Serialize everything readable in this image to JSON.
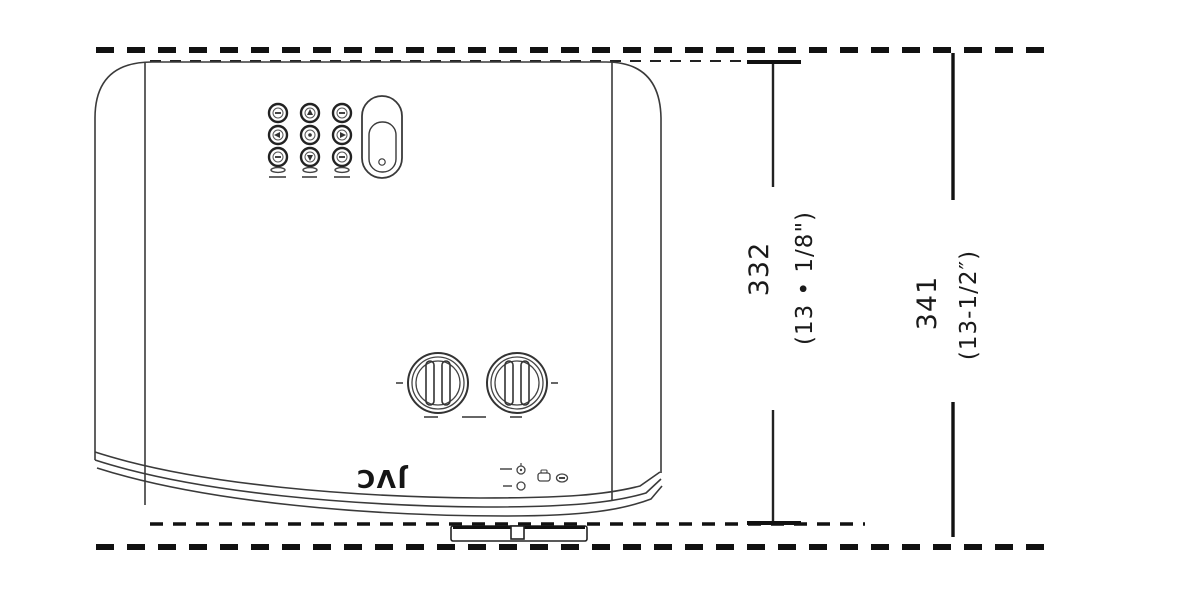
{
  "diagram": {
    "logo_text": "JVC",
    "dim_inner_mm": "332",
    "dim_inner_in": "(13 • 1/8\")",
    "dim_outer_mm": "341",
    "dim_outer_in": "(13-1/2″)"
  },
  "colors": {
    "line": "#333333",
    "dash": "#111111",
    "text": "#1a1a1a",
    "background": "#ffffff"
  },
  "icons": [
    "arrow-up-button",
    "arrow-down-button",
    "arrow-left-button",
    "arrow-right-button",
    "ok-button",
    "function-button",
    "power-slider",
    "focus-dial",
    "zoom-dial",
    "indicator-led",
    "lamp-icon",
    "rear-foot"
  ]
}
